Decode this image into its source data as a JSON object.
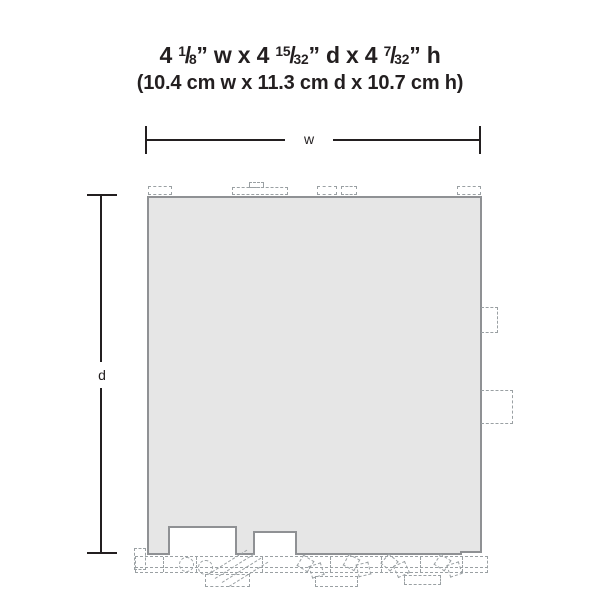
{
  "diagram": {
    "title": {
      "line1_parts": [
        {
          "text": "4 "
        },
        {
          "frac": [
            "1",
            "8"
          ]
        },
        {
          "text": "” w x 4 "
        },
        {
          "frac": [
            "15",
            "32"
          ]
        },
        {
          "text": "” d x 4 "
        },
        {
          "frac": [
            "7",
            "32"
          ]
        },
        {
          "text": "” h"
        }
      ],
      "line1_plain": "4 1/8” w x 4 15/32” d x 4 7/32” h",
      "line2": "(10.4 cm w x 11.3 cm d x 10.7 cm h)"
    },
    "dimensions": {
      "width_in": "4 1/8”",
      "depth_in": "4 15/32”",
      "height_in": "4 7/32”",
      "width_cm": "10.4 cm",
      "depth_cm": "11.3 cm",
      "height_cm": "10.7 cm"
    },
    "dimension_labels": {
      "width": "w",
      "depth": "d"
    },
    "colors": {
      "footprint_fill": "#e6e6e6",
      "footprint_outline": "#8f9194",
      "dashed_detail": "#9aa0a3",
      "text_and_dimension_lines": "#231f20",
      "background": "#ffffff"
    }
  }
}
